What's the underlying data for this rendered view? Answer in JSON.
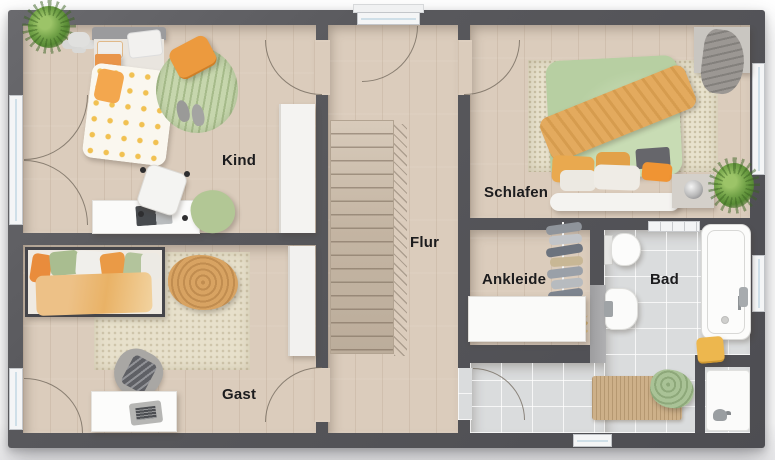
{
  "plan": {
    "rooms": [
      {
        "id": "kind",
        "label": "Kind"
      },
      {
        "id": "gast",
        "label": "Gast"
      },
      {
        "id": "flur",
        "label": "Flur"
      },
      {
        "id": "schlafen",
        "label": "Schlafen"
      },
      {
        "id": "ankleide",
        "label": "Ankleide"
      },
      {
        "id": "bad",
        "label": "Bad"
      }
    ],
    "colors": {
      "wall": "#58585c",
      "wood_floor": "#dbccbc",
      "tile_floor": "#dadcdd",
      "accent_orange": "#e9954a",
      "accent_green": "#b7cfa2",
      "rug_beige": "#e7e0cb"
    }
  }
}
